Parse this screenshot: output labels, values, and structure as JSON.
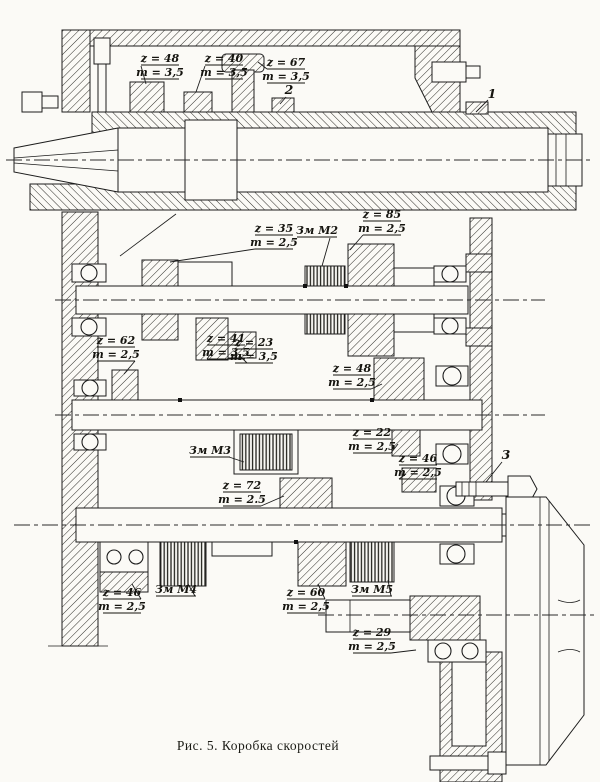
{
  "figure_caption": "Рис. 5. Коробка скоростей",
  "callouts": {
    "c1": "1",
    "c2": "2",
    "c3": "3"
  },
  "gear_labels": [
    {
      "name": "spindle-gear-z48",
      "z": "z = 48",
      "m": "m = 3,5"
    },
    {
      "name": "spindle-gear-z40",
      "z": "z = 40",
      "m": "m = 3,5"
    },
    {
      "name": "spindle-gear-z67",
      "z": "z = 67",
      "m": "m = 3,5"
    },
    {
      "name": "shaft2-gear-z35",
      "z": "z = 35",
      "m": "m = 2,5"
    },
    {
      "name": "shaft2-gear-z85",
      "z": "z = 85",
      "m": "m = 2,5"
    },
    {
      "name": "shaft3-gear-z62",
      "z": "z = 62",
      "m": "m = 2,5"
    },
    {
      "name": "shaft2-gear-z41",
      "z": "z = 41",
      "m": "m = 3,5"
    },
    {
      "name": "shaft2-gear-z23",
      "z": "z = 23",
      "m": "m = 3,5"
    },
    {
      "name": "shaft3-gear-z48",
      "z": "z = 48",
      "m": "m = 2,5"
    },
    {
      "name": "shaft3-gear-z22",
      "z": "z = 22",
      "m": "m = 2,5"
    },
    {
      "name": "shaft3-gear-z46",
      "z": "z = 46",
      "m": "m = 2,5"
    },
    {
      "name": "shaft4-gear-z72",
      "z": "z = 72",
      "m": "m = 2.5"
    },
    {
      "name": "shaft4-gear-z46",
      "z": "z = 46",
      "m": "m = 2,5"
    },
    {
      "name": "shaft4-gear-z60",
      "z": "z = 60",
      "m": "m = 2,5"
    },
    {
      "name": "output-gear-z29",
      "z": "z = 29",
      "m": "m = 2,5"
    }
  ],
  "clutch_labels": [
    {
      "name": "clutch-M2",
      "text": "Зм М2"
    },
    {
      "name": "clutch-M3",
      "text": "Зм М3"
    },
    {
      "name": "clutch-M4",
      "text": "Зм М4"
    },
    {
      "name": "clutch-M5",
      "text": "Зм М5"
    }
  ]
}
